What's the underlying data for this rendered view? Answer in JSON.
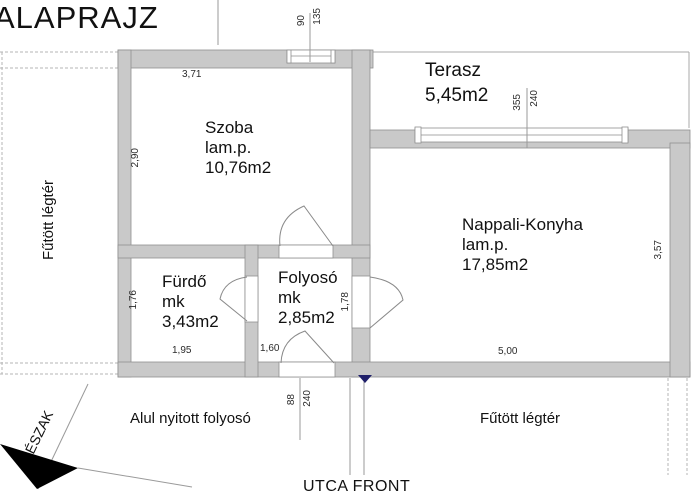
{
  "title": "ALAPRAJZ",
  "rooms": {
    "szoba": {
      "name": "Szoba",
      "floor": "lam.p.",
      "area": "10,76m2"
    },
    "terasz": {
      "name": "Terasz",
      "area": "5,45m2"
    },
    "nappali_konyha": {
      "name": "Nappali-Konyha",
      "floor": "lam.p.",
      "area": "17,85m2"
    },
    "furdo": {
      "name": "Fürdő",
      "floor": "mk",
      "area": "3,43m2"
    },
    "folyoso": {
      "name": "Folyosó",
      "floor": "mk",
      "area": "2,85m2"
    }
  },
  "zones": {
    "left_vertical": "Fűtött légtér",
    "bottom_left": "Alul nyitott folyosó",
    "bottom_right": "Fűtött légtér",
    "street_front": "UTCA FRONT",
    "north_label": "ÉSZAK"
  },
  "dimensions": {
    "szoba_width": "3,71",
    "szoba_height": "2,90",
    "furdo_height": "1,76",
    "furdo_width": "1,95",
    "folyoso_width": "1,60",
    "folyoso_height": "1,78",
    "nappali_width": "5,00",
    "nappali_height": "3,57",
    "szoba_window_width": "90",
    "szoba_window_height": "135",
    "terasz_window_width": "355",
    "terasz_window_height": "240",
    "entry_door_width": "88",
    "entry_door_height": "240"
  },
  "colors": {
    "wall_fill": "#c9c9c9",
    "entry_marker": "#20206a",
    "north_arrow": "#000000"
  }
}
